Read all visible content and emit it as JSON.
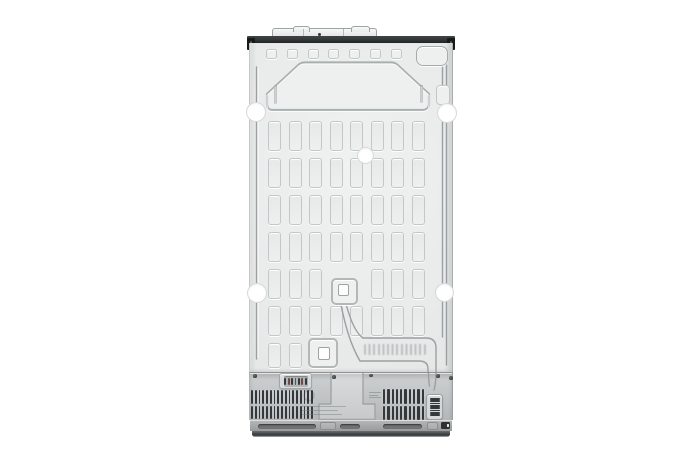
{
  "meta": {
    "description": "Product photo: rear view of a stainless-steel side-by-side refrigerator showing the embossed sheet-metal back panel, capillary tubing, compressor compartment vents and base grille on a plain white background",
    "visible_text": "none (stamped code and molded labels are illegible)"
  },
  "colors": {
    "bg": "#ffffff",
    "panel": "#e9ebeb",
    "emboss-fill": "#eef0f0",
    "line": "#c3c7c7",
    "line-strong": "#a9afaf",
    "cap-line": "#9ea3a4",
    "top-band": "#2e3233",
    "bracket": "#17191a",
    "cover": "#c8cbcc",
    "slat": "#34383a",
    "slat-red": "#6e4a45",
    "plate": "#d8dbdb",
    "plate-recess": "#b2b5b6",
    "base-slot": "#6f7374",
    "base-dark": "#313536",
    "tube": "#9aa0a1",
    "hole-ring": "#d7dada"
  },
  "figure": {
    "top_squares": {
      "count": 7
    },
    "grid": {
      "cols": 8,
      "rows": 7,
      "x0": 18,
      "y0": 78,
      "pitch_x": 20.5,
      "pitch_y": 37,
      "w": 13,
      "h": 30,
      "last_row_h": 25,
      "skips": [
        [
          4,
          3
        ],
        [
          4,
          4
        ],
        [
          6,
          2
        ],
        [
          6,
          3
        ],
        [
          6,
          4
        ],
        [
          6,
          5
        ],
        [
          6,
          6
        ],
        [
          6,
          7
        ]
      ]
    },
    "mount_holes": [
      {
        "x": 5.5,
        "y": 68.5,
        "r": 9
      },
      {
        "x": 197,
        "y": 70,
        "r": 9
      },
      {
        "x": 115,
        "y": 112,
        "r": 7.5
      },
      {
        "x": 7,
        "y": 250,
        "r": 9
      },
      {
        "x": 194,
        "y": 249,
        "r": 8.5
      }
    ],
    "vents": {
      "left": {
        "x": 1,
        "y": 17,
        "w": 62,
        "h": 29,
        "slats": 17
      },
      "right": {
        "x": 133,
        "y": 16,
        "w": 41,
        "h": 31,
        "slats": 10
      },
      "grille_slats": 8,
      "plate_slats": 7
    },
    "base_slots": [
      {
        "x": 8,
        "w": 58
      },
      {
        "x": 90,
        "w": 20
      },
      {
        "x": 133,
        "w": 39
      }
    ],
    "label_lines": {
      "widths": [
        44,
        36,
        40
      ]
    },
    "label_tiny": {
      "widths": [
        12,
        9,
        12
      ]
    },
    "cover_screws": [
      {
        "x": 3,
        "y": 1
      },
      {
        "x": 82,
        "y": 2
      },
      {
        "x": 119,
        "y": 0.5
      },
      {
        "x": 186,
        "y": 1
      },
      {
        "x": 199,
        "y": 3
      }
    ]
  }
}
